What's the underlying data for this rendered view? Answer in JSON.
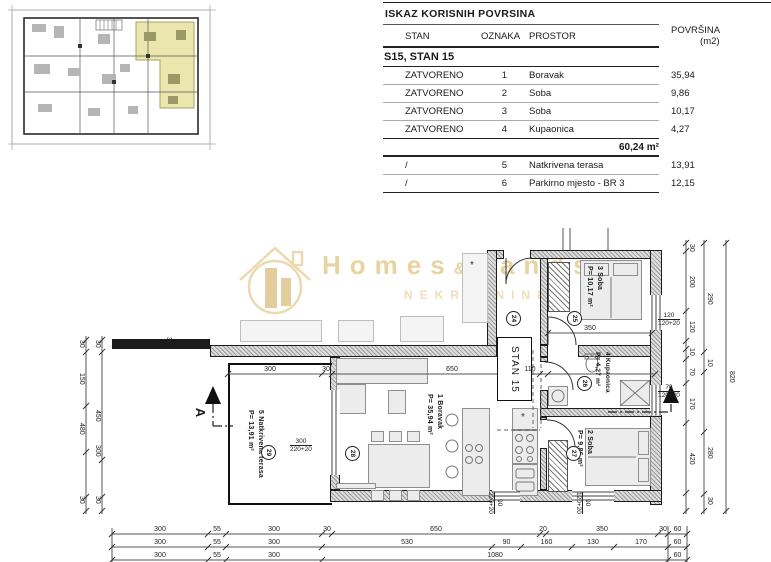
{
  "table": {
    "title": "ISKAZ KORISNIH POVRSINA",
    "headers": {
      "stan": "STAN",
      "oznaka": "OZNAKA",
      "prostor": "PROSTOR",
      "povrsina": "POVRŠINA (m2)"
    },
    "section": "S15, STAN 15",
    "rows": [
      {
        "stan": "ZATVORENO",
        "oznaka": "1",
        "prostor": "Boravak",
        "povrsina": "35,94"
      },
      {
        "stan": "ZATVORENO",
        "oznaka": "2",
        "prostor": "Soba",
        "povrsina": "9,86"
      },
      {
        "stan": "ZATVORENO",
        "oznaka": "3",
        "prostor": "Soba",
        "povrsina": "10,17"
      },
      {
        "stan": "ZATVORENO",
        "oznaka": "4",
        "prostor": "Kupaonica",
        "povrsina": "4,27"
      }
    ],
    "total": "60,24 m²",
    "open_rows": [
      {
        "stan": "/",
        "oznaka": "5",
        "prostor": "Natkrivena terasa",
        "povrsina": "13,91"
      },
      {
        "stan": "/",
        "oznaka": "6",
        "prostor": "Parkirno mjesto - BR 3",
        "povrsina": "12,15"
      }
    ]
  },
  "watermark": {
    "word1": "Homes",
    "amp": "&",
    "word2": "Lands",
    "subtitle": "NEKRETNINE",
    "color": "#e8d3a2"
  },
  "plan": {
    "unit_label": "STAN 15",
    "section_label": "A",
    "fixture_symbol": "*",
    "rooms": [
      {
        "id": "boravak",
        "num": "1",
        "name": "Boravak",
        "area": "P= 35,94 m²",
        "marker": "28"
      },
      {
        "id": "soba3",
        "num": "3",
        "name": "Soba",
        "area": "P= 10,17 m²",
        "marker": "25"
      },
      {
        "id": "kupaonica",
        "num": "4",
        "name": "Kupaonica",
        "area": "P= 4,27 m²",
        "marker": "26"
      },
      {
        "id": "soba2",
        "num": "2",
        "name": "Soba",
        "area": "P= 9,86 m²",
        "marker": "27"
      },
      {
        "id": "terasa",
        "num": "5",
        "name": "Natkrivena terasa",
        "area": "P= 13,91 m²",
        "marker": "29"
      }
    ],
    "hall_marker": "24",
    "dims": {
      "bottom_rows": [
        [
          "300",
          "55",
          "300",
          "30",
          "650",
          "20",
          "350",
          "30",
          "60"
        ],
        [
          "300",
          "55",
          "300",
          "530",
          "90",
          "160",
          "130",
          "170",
          "60"
        ],
        [
          "300",
          "55",
          "300",
          "1080",
          "60"
        ]
      ],
      "right_col_a": [
        "30",
        "200",
        "120",
        "10",
        "70",
        "170",
        "420"
      ],
      "right_col_b": [
        "290",
        "10",
        "280",
        "30"
      ],
      "right_col_c": [
        "820"
      ],
      "left_col_a": [
        "30",
        "150",
        "480",
        "30"
      ],
      "left_col_b": [
        "30",
        "450",
        "300",
        "30"
      ],
      "interior_h": [
        "300",
        "30",
        "650",
        "110"
      ],
      "room3_width": "350",
      "extra": [
        "30"
      ]
    },
    "window_labels": [
      {
        "w": "120",
        "s": "120+20"
      },
      {
        "w": "70",
        "s": "120+20"
      },
      {
        "w": "90",
        "s": "220+20"
      },
      {
        "w": "90",
        "s": "120+20"
      },
      {
        "w": "300",
        "s": "220+20"
      }
    ]
  }
}
